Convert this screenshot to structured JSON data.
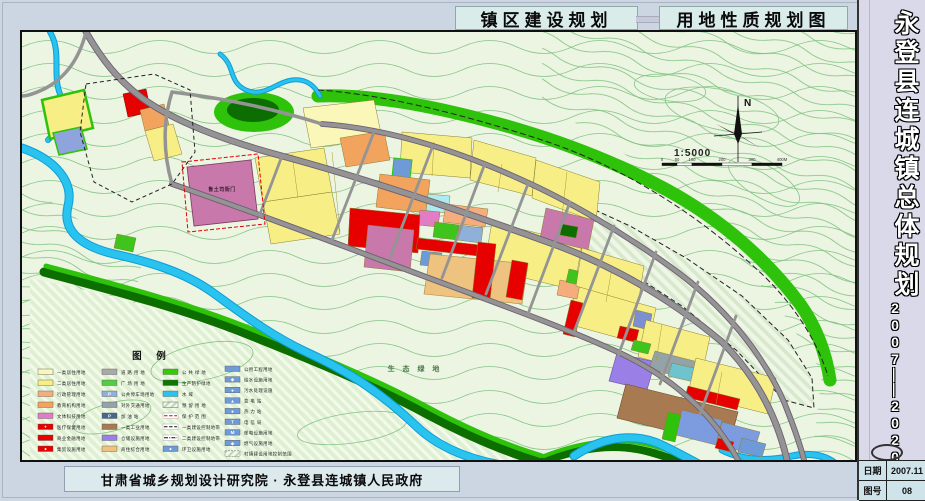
{
  "header": {
    "title_left": "镇区建设规划",
    "title_right": "用地性质规划图"
  },
  "sidebar": {
    "title": "永登县连城镇总体规划",
    "years1": "2007",
    "dash1": "—",
    "dash2": "—",
    "years2": "2020",
    "table": {
      "date_label": "日期",
      "date_value": "2007.11",
      "no_label": "图号",
      "no_value": "08"
    }
  },
  "footer": {
    "credit": "甘肃省城乡规划设计研究院 · 永登县连城镇人民政府"
  },
  "map": {
    "north_label": "N",
    "scale_text": "1:5000",
    "scale_ticks": [
      "0",
      "50",
      "100",
      "200",
      "300",
      "400M"
    ],
    "seg_w": [
      15,
      15,
      30,
      30,
      30
    ],
    "labels": [
      {
        "t": "鲁土司衙门",
        "x": 200,
        "y": 159,
        "s": 5,
        "c": "#3c1f30",
        "ls": 0.5
      },
      {
        "t": "生 态 绿 地",
        "x": 393,
        "y": 339,
        "s": 7,
        "c": "#4a7a4a",
        "ls": 3
      }
    ],
    "hatches": [
      {
        "pts": "8,246 90,264 170,288 250,314 340,348 430,388 500,420 518,428 8,428",
        "f": "url(#hEco)"
      },
      {
        "pts": "536,182 560,172 608,194 664,226 720,264 766,308 790,346 792,376 762,368 714,318 660,274 604,238 552,210 530,192",
        "f": "url(#hRes)",
        "s": "#222",
        "dash": "5,3"
      }
    ],
    "ellipses": [
      {
        "cx": 700,
        "cy": 78,
        "rx": 58,
        "ry": 20,
        "rot": 12,
        "s": "#85c385"
      },
      {
        "cx": 648,
        "cy": 56,
        "rx": 36,
        "ry": 13,
        "rot": 8,
        "s": "#85c385"
      },
      {
        "cx": 742,
        "cy": 150,
        "rx": 40,
        "ry": 16,
        "rot": 30,
        "s": "#85c385"
      },
      {
        "cx": 180,
        "cy": 330,
        "rx": 52,
        "ry": 18,
        "rot": -12,
        "s": "#85c385"
      },
      {
        "cx": 330,
        "cy": 396,
        "rx": 55,
        "ry": 15,
        "rot": -8,
        "s": "#85c385"
      },
      {
        "cx": 90,
        "cy": 385,
        "rx": 40,
        "ry": 14,
        "rot": -15,
        "s": "#85c385"
      },
      {
        "cx": 232,
        "cy": 80,
        "rx": 40,
        "ry": 20,
        "f": "#2ec20a"
      },
      {
        "cx": 231,
        "cy": 78,
        "rx": 26,
        "ry": 12,
        "f": "#0c6e00"
      },
      {
        "cx": 482,
        "cy": 220,
        "rx": 7,
        "ry": 6,
        "f": "#2ec20a"
      }
    ],
    "greens": [
      {
        "d": "M296,64 C 350,62 410,74 470,90 C 530,106 590,128 645,158 C 700,188 745,228 778,272 C 795,296 804,322 808,348",
        "c": "#2ec20a",
        "w": 13
      },
      {
        "d": "M22,240 C 90,258 160,276 225,302 C 290,328 350,352 405,382 C 450,406 485,420 518,430",
        "c": "#0d6e00",
        "w": 9
      },
      {
        "d": "M24,234 C 92,252 162,270 227,296 C 292,322 352,346 407,376 C 452,400 487,414 520,424",
        "c": "#2ec20a",
        "w": 5
      },
      {
        "d": "M520,430 C 556,416 592,410 628,420 C 660,429 686,441 706,452",
        "c": "#0d6e00",
        "w": 8
      },
      {
        "d": "M522,424 C 558,410 594,404 630,414 C 662,423 688,435 708,446",
        "c": "#2ec20a",
        "w": 4
      }
    ],
    "rivers": [
      {
        "d": "M0,116 C 34,128 52,150 46,174 C 40,198 58,214 92,222 C 128,230 162,240 190,260 C 218,280 246,302 284,320 C 332,342 362,364 392,392 C 414,414 444,426 474,432 C 496,436 512,442 524,452",
        "w": 7
      },
      {
        "d": "M28,0 C 40,20 30,42 38,62 C 44,78 38,96 26,108",
        "w": 4
      },
      {
        "d": "M198,22 C 214,34 206,50 224,58 C 242,66 254,50 270,48 C 286,46 294,56 298,64",
        "w": 3
      },
      {
        "d": "M552,424 C 582,404 614,400 642,414 C 668,427 692,440 714,454",
        "w": 7
      },
      {
        "d": "M700,418 C 720,428 744,430 770,424 C 790,420 804,424 814,432",
        "w": 5
      }
    ],
    "parcels": [
      {
        "pts": "20,68 62,58 71,96 28,107",
        "f": "#f7ef86",
        "s": "#2ec20a",
        "sw": 2.5
      },
      {
        "pts": "31,101 59,95 65,117 37,123",
        "f": "#8fa3dc",
        "s": "#2ec20a",
        "sw": 1.5
      },
      {
        "pts": "101,62 124,57 129,80 106,85",
        "f": "#e60000",
        "s": "#8a0000"
      },
      {
        "pts": "118,78 142,72 147,93 123,99",
        "f": "#f2a35e"
      },
      {
        "pts": "123,99 151,92 160,122 132,129",
        "f": "#f7ef86"
      },
      {
        "pts": "165,135 229,128 236,187 172,194",
        "f": "#c878aa",
        "s": "#7a3a60",
        "sw": 0.8
      },
      {
        "pts": "233,126 302,116 310,160 241,170",
        "f": "#f7ef86"
      },
      {
        "pts": "241,170 310,160 318,202 249,212",
        "f": "#f7ef86"
      },
      {
        "pts": "281,76 352,68 360,106 289,116",
        "f": "#fbf7b8"
      },
      {
        "pts": "318,106 362,99 368,128 324,135",
        "f": "#f2a35e"
      },
      {
        "pts": "380,100 450,106 448,146 378,140",
        "f": "#f7ef86"
      },
      {
        "pts": "452,108 514,126 510,164 448,148",
        "f": "#f7ef86"
      },
      {
        "pts": "514,128 578,150 574,190 510,166",
        "f": "#f7ef86"
      },
      {
        "pts": "372,126 390,128 388,147 370,145",
        "f": "#6f9ad8",
        "s": "#2ec20a",
        "sw": 1
      },
      {
        "pts": "358,142 408,148 404,181 354,175",
        "f": "#f2a35e"
      },
      {
        "pts": "406,162 428,164 426,181 404,179",
        "f": "#aeeaf0"
      },
      {
        "pts": "398,178 418,180 416,195 396,193",
        "f": "#e27cc3"
      },
      {
        "pts": "424,172 466,177 463,195 421,190",
        "f": "#f5ad7e"
      },
      {
        "pts": "413,190 437,193 435,208 411,205",
        "f": "#3fc41e"
      },
      {
        "pts": "437,193 461,196 459,211 435,208",
        "f": "#8fb0d8"
      },
      {
        "pts": "470,190 560,212 552,258 462,236",
        "f": "#f7ef86"
      },
      {
        "pts": "524,176 572,188 566,218 518,206",
        "f": "#c878aa"
      },
      {
        "pts": "540,192 556,195 554,206 538,203",
        "f": "#0c6e00"
      },
      {
        "pts": "554,254 634,276 626,314 546,292",
        "f": "#f7ef86"
      },
      {
        "pts": "328,176 398,183 396,221 326,214",
        "f": "#e60000"
      },
      {
        "pts": "346,193 392,198 388,240 342,235",
        "f": "#c878aa"
      },
      {
        "pts": "396,206 458,213 456,224 394,217",
        "f": "#e60000"
      },
      {
        "pts": "400,219 420,221 418,235 398,233",
        "f": "#6f9ad8"
      },
      {
        "pts": "408,222 506,232 500,272 402,262",
        "f": "#eec27f",
        "s": "#b08a40",
        "sw": 0.6
      },
      {
        "pts": "456,210 474,212 468,268 450,266",
        "f": "#e60000"
      },
      {
        "pts": "490,228 506,231 500,268 484,265",
        "f": "#e60000"
      },
      {
        "pts": "538,248 558,252 555,267 535,263",
        "f": "#f5ad7e"
      },
      {
        "pts": "547,237 565,241 562,254 544,250",
        "f": "#3fc41e"
      },
      {
        "pts": "549,268 561,271 553,305 541,302",
        "f": "#e60000"
      },
      {
        "pts": "560,216 622,234 616,272 554,254",
        "f": "#f7ef86"
      },
      {
        "pts": "614,278 630,282 627,298 611,294",
        "f": "#7d8fd0"
      },
      {
        "pts": "598,294 617,298 614,310 595,306",
        "f": "#e60000"
      },
      {
        "pts": "624,288 688,305 680,342 616,325",
        "f": "#f7ef86"
      },
      {
        "pts": "612,308 629,312 626,322 609,318",
        "f": "#3fc41e"
      },
      {
        "pts": "595,321 633,330 625,358 587,349",
        "f": "#9a7fe6",
        "s": "#6a50b0",
        "sw": 0.6
      },
      {
        "pts": "633,319 688,333 682,351 627,337",
        "f": "#93a3a8"
      },
      {
        "pts": "650,331 676,337 672,350 646,344",
        "f": "#6fc3cf"
      },
      {
        "pts": "674,326 754,346 746,382 666,362",
        "f": "#f7ef86"
      },
      {
        "pts": "666,354 718,367 715,378 663,365",
        "f": "#e60000"
      },
      {
        "pts": "604,352 716,380 707,414 595,386",
        "f": "#a87a52",
        "s": "#6a4a28",
        "sw": 0.6
      },
      {
        "pts": "660,378 700,388 694,413 654,403",
        "f": "#7d9ce0"
      },
      {
        "pts": "700,390 738,400 731,422 694,413",
        "f": "#7d9ce0"
      },
      {
        "pts": "646,380 659,383 653,410 640,407",
        "f": "#2ec20a"
      },
      {
        "pts": "696,406 712,410 709,420 693,416",
        "f": "#e60000"
      },
      {
        "pts": "720,406 744,412 740,425 716,420",
        "f": "#6f9ad8"
      },
      {
        "pts": "95,202 114,206 111,220 92,216",
        "f": "#3fc41e"
      }
    ],
    "plines": [
      {
        "d": "M310,120 L 318,200"
      },
      {
        "d": "M412,110 L 410,144"
      },
      {
        "d": "M480,132 L 476,160"
      },
      {
        "d": "M545,140 L 540,184"
      },
      {
        "d": "M590,236 L 584,270"
      },
      {
        "d": "M700,340 L 694,372"
      },
      {
        "d": "M270,122 L 276,166"
      },
      {
        "d": "M640,292 L 634,330"
      }
    ],
    "roads": [
      {
        "d": "M64,0 C 80,28 96,48 120,66 C 150,88 200,108 260,124 C 330,143 420,172 520,208 C 590,232 650,268 700,310 C 735,345 755,385 765,428",
        "w": 5,
        "c": 1
      },
      {
        "d": "M300,92 C 360,96 430,116 500,148 C 545,168 600,200 650,236 C 700,272 740,320 762,370 C 772,395 778,412 782,428",
        "w": 4,
        "c": 1
      },
      {
        "d": "M150,152 C 220,176 300,206 380,236 C 460,266 540,294 600,322 C 650,346 690,380 716,428",
        "w": 4,
        "c": 1
      },
      {
        "d": "M150,60 C 200,66 250,76 300,92",
        "w": 3.5
      },
      {
        "d": "M150,60 C 140,92 142,124 150,152",
        "w": 3.5
      },
      {
        "d": "M64,0 C 58,24 46,44 24,56 C 12,62 4,64 0,64",
        "w": 3.5
      },
      {
        "d": "M352,100 L 310,208",
        "w": 2.8
      },
      {
        "d": "M410,116 L 368,226",
        "w": 2.8
      },
      {
        "d": "M462,134 L 420,246",
        "w": 2.8
      },
      {
        "d": "M506,152 L 464,262",
        "w": 2.8
      },
      {
        "d": "M548,170 L 506,282",
        "w": 2.8
      },
      {
        "d": "M592,194 L 552,300",
        "w": 2.8
      },
      {
        "d": "M634,220 L 596,324",
        "w": 2.8
      },
      {
        "d": "M676,250 L 638,352",
        "w": 2.8
      },
      {
        "d": "M714,284 L 678,382",
        "w": 2.8
      },
      {
        "d": "M260,124 L 238,182",
        "w": 2.8
      }
    ],
    "dashes": [
      {
        "pts": "64,52 132,42 168,58 173,120 150,152 110,170 72,150 58,100",
        "c": "#222",
        "dash": "4,3"
      },
      {
        "d": "M296,58 C 360,62 440,82 520,108 C 600,134 680,184 744,246 C 776,278 796,312 806,344",
        "c": "#222",
        "dash": "6,3"
      },
      {
        "pts": "160,130 236,122 243,192 166,200",
        "c": "#e60000",
        "dash": "4,2"
      }
    ]
  },
  "legend": {
    "title": "图    例",
    "cols_x": [
      16,
      80,
      141,
      203
    ],
    "cols": [
      [
        {
          "l": "一类居住用地",
          "f": "#fbf7b8"
        },
        {
          "l": "二类居住用地",
          "f": "#f7ef86"
        },
        {
          "l": "行政管理用地",
          "f": "#f5ad7e"
        },
        {
          "l": "教育机构用地",
          "f": "#f2a35e"
        },
        {
          "l": "文体科技用地",
          "f": "#e27cc3"
        },
        {
          "l": "医疗保健用地",
          "f": "#e60000",
          "ic": "+"
        },
        {
          "l": "商业金融用地",
          "f": "#e60000"
        },
        {
          "l": "集贸设施用地",
          "f": "#e60000",
          "ic": "●"
        }
      ],
      [
        {
          "l": "道 路 用 地",
          "f": "#a9a9a9"
        },
        {
          "l": "广 场 用 地",
          "f": "#55cc44"
        },
        {
          "l": "公共停车场用地",
          "f": "#8fb0d8",
          "ic": "P"
        },
        {
          "l": "对外交通用地",
          "f": "#93a3a8"
        },
        {
          "l": "加 油 站",
          "f": "#46688e",
          "ic": "P"
        },
        {
          "l": "一类工业用地",
          "f": "#a87a52"
        },
        {
          "l": "仓储设施用地",
          "f": "#9a7fe6"
        },
        {
          "l": "商住综合用地",
          "f": "#eec27f"
        }
      ],
      [
        {
          "l": "公 共 绿 地",
          "f": "#33cc00"
        },
        {
          "l": "生产防护绿地",
          "f": "#0f7700"
        },
        {
          "l": "水       域",
          "f": "#29c3ef"
        },
        {
          "l": "预 留 用 地",
          "ty": "hatch"
        },
        {
          "l": "保 护 范 围",
          "ty": "lineRed"
        },
        {
          "l": "一类建设控制地带",
          "ty": "lineDash"
        },
        {
          "l": "二类建设控制地带",
          "ty": "lineDD"
        },
        {
          "l": "环卫设施用地",
          "f": "#6f9ad8",
          "ic": "●"
        }
      ],
      [
        {
          "l": "公用工程用地",
          "f": "#6f9ad8"
        },
        {
          "l": "给水设施用地",
          "f": "#6f9ad8",
          "ic": "◆"
        },
        {
          "l": "污水处理设施",
          "f": "#6f9ad8",
          "ic": "●"
        },
        {
          "l": "变 电 站",
          "f": "#6f9ad8",
          "ic": "▲"
        },
        {
          "l": "热 力 站",
          "f": "#6f9ad8",
          "ic": "●"
        },
        {
          "l": "电 信 局",
          "f": "#6f9ad8",
          "ic": "T"
        },
        {
          "l": "邮电设施用地",
          "f": "#6f9ad8",
          "ic": "M"
        },
        {
          "l": "燃气设施用地",
          "f": "#6f9ad8",
          "ic": "◆"
        },
        {
          "l": "村镇建设用地控制范围",
          "ty": "hatchBox"
        }
      ]
    ]
  },
  "colors": {
    "page_bg": "#ccd5e2",
    "map_bg": "#ebf5e2",
    "river": "#29c3ef",
    "river_edge": "#0f9cd8",
    "green_bright": "#2ec20a",
    "green_dark": "#0d6e00",
    "road": "#949494",
    "road_edge": "#6f5f72",
    "residential": "#f7ef86",
    "commercial": "#e60000",
    "industry": "#a87a52",
    "utility": "#6f9ad8"
  }
}
